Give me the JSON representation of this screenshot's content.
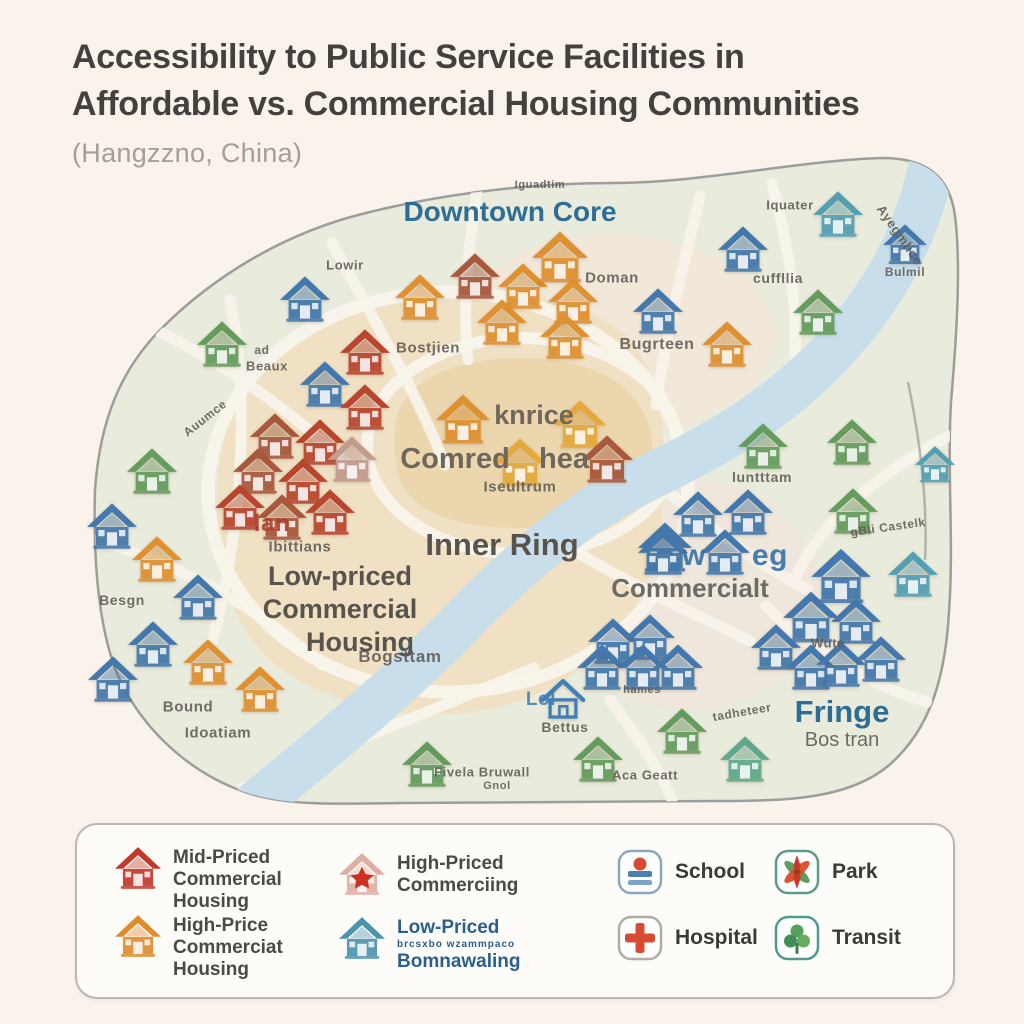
{
  "title": {
    "line1": "Accessibility to Public Service Facilities in",
    "line2": "Affordable vs. Commercial Housing Communities",
    "subtitle": "(Hangzzno, China)"
  },
  "map": {
    "region_labels": {
      "downtown_core": "Downtown Core",
      "inner_ring": "Inner Ring",
      "low_priced_1": "Low-priced",
      "low_priced_2": "Commercial",
      "low_priced_3": "Housing",
      "commercial": "Commercialt",
      "fringe": "Fringe",
      "fringe_sub": "Bos tran",
      "core_1": "knrice",
      "core_2": "Comred",
      "core_3": "hea"
    },
    "colors": {
      "red": "#b9452f",
      "brown": "#a8583c",
      "fadedred": "#c49b90",
      "orange": "#df9130",
      "yellow": "#e5a93b",
      "blue": "#4278ad",
      "teal": "#53a0b5",
      "green": "#649c5d",
      "tealgreen": "#5ea98e",
      "outline": "#3f7fb5",
      "map_sage": "#e9ebdc",
      "map_tan": "#f0e1c4",
      "map_core": "#ecd6ae",
      "river": "#c8dfeb",
      "accent_teal_text": "#2e6d94"
    },
    "houses": [
      {
        "x": 305,
        "y": 300,
        "c": "blue"
      },
      {
        "x": 222,
        "y": 345,
        "c": "green"
      },
      {
        "x": 152,
        "y": 472,
        "c": "green"
      },
      {
        "x": 112,
        "y": 527,
        "c": "blue"
      },
      {
        "x": 157,
        "y": 560,
        "c": "orange"
      },
      {
        "x": 198,
        "y": 598,
        "c": "blue"
      },
      {
        "x": 153,
        "y": 645,
        "c": "blue"
      },
      {
        "x": 113,
        "y": 680,
        "c": "blue"
      },
      {
        "x": 208,
        "y": 663,
        "c": "orange"
      },
      {
        "x": 260,
        "y": 690,
        "c": "orange"
      },
      {
        "x": 365,
        "y": 353,
        "c": "red"
      },
      {
        "x": 325,
        "y": 385,
        "c": "blue"
      },
      {
        "x": 365,
        "y": 408,
        "c": "red"
      },
      {
        "x": 275,
        "y": 437,
        "c": "brown"
      },
      {
        "x": 320,
        "y": 443,
        "c": "red"
      },
      {
        "x": 352,
        "y": 460,
        "c": "fadedred"
      },
      {
        "x": 258,
        "y": 472,
        "c": "brown"
      },
      {
        "x": 303,
        "y": 482,
        "c": "red"
      },
      {
        "x": 240,
        "y": 508,
        "c": "red"
      },
      {
        "x": 282,
        "y": 518,
        "c": "brown"
      },
      {
        "x": 330,
        "y": 513,
        "c": "red"
      },
      {
        "x": 420,
        "y": 298,
        "c": "orange"
      },
      {
        "x": 475,
        "y": 277,
        "c": "brown"
      },
      {
        "x": 523,
        "y": 287,
        "c": "orange"
      },
      {
        "x": 560,
        "y": 258,
        "c": "orange",
        "s": 56
      },
      {
        "x": 573,
        "y": 302,
        "c": "orange"
      },
      {
        "x": 502,
        "y": 323,
        "c": "orange"
      },
      {
        "x": 565,
        "y": 337,
        "c": "orange"
      },
      {
        "x": 658,
        "y": 312,
        "c": "blue"
      },
      {
        "x": 727,
        "y": 345,
        "c": "orange"
      },
      {
        "x": 463,
        "y": 420,
        "c": "orange",
        "s": 54
      },
      {
        "x": 580,
        "y": 425,
        "c": "yellow",
        "s": 52
      },
      {
        "x": 520,
        "y": 463,
        "c": "yellow",
        "s": 52
      },
      {
        "x": 607,
        "y": 460,
        "c": "brown",
        "s": 52
      },
      {
        "x": 665,
        "y": 548,
        "c": "blue",
        "s": 54
      },
      {
        "x": 743,
        "y": 250,
        "c": "blue"
      },
      {
        "x": 838,
        "y": 215,
        "c": "teal"
      },
      {
        "x": 818,
        "y": 313,
        "c": "green"
      },
      {
        "x": 905,
        "y": 245,
        "c": "blue",
        "s": 44
      },
      {
        "x": 763,
        "y": 447,
        "c": "green"
      },
      {
        "x": 852,
        "y": 443,
        "c": "green"
      },
      {
        "x": 853,
        "y": 512,
        "c": "green"
      },
      {
        "x": 935,
        "y": 465,
        "c": "teal",
        "s": 40
      },
      {
        "x": 698,
        "y": 515,
        "c": "blue"
      },
      {
        "x": 748,
        "y": 513,
        "c": "blue"
      },
      {
        "x": 663,
        "y": 553,
        "c": "blue"
      },
      {
        "x": 725,
        "y": 553,
        "c": "blue"
      },
      {
        "x": 613,
        "y": 642,
        "c": "blue"
      },
      {
        "x": 650,
        "y": 638,
        "c": "blue"
      },
      {
        "x": 602,
        "y": 668,
        "c": "blue"
      },
      {
        "x": 643,
        "y": 668,
        "c": "blue"
      },
      {
        "x": 678,
        "y": 668,
        "c": "blue"
      },
      {
        "x": 841,
        "y": 577,
        "c": "blue",
        "s": 60
      },
      {
        "x": 913,
        "y": 575,
        "c": "teal"
      },
      {
        "x": 811,
        "y": 618,
        "c": "blue",
        "s": 56
      },
      {
        "x": 856,
        "y": 622,
        "c": "blue"
      },
      {
        "x": 776,
        "y": 648,
        "c": "blue"
      },
      {
        "x": 811,
        "y": 668,
        "c": "blue"
      },
      {
        "x": 841,
        "y": 665,
        "c": "blue"
      },
      {
        "x": 881,
        "y": 660,
        "c": "blue"
      },
      {
        "x": 427,
        "y": 765,
        "c": "green"
      },
      {
        "x": 598,
        "y": 760,
        "c": "green"
      },
      {
        "x": 682,
        "y": 732,
        "c": "green"
      },
      {
        "x": 745,
        "y": 760,
        "c": "tealgreen"
      },
      {
        "x": 563,
        "y": 700,
        "c": "outline",
        "o": 1,
        "s": 46
      }
    ],
    "micro_labels": [
      {
        "t": "Iguadtim",
        "x": 540,
        "y": 185,
        "size": 11
      },
      {
        "t": "Lowir",
        "x": 345,
        "y": 265,
        "size": 13
      },
      {
        "t": "ad",
        "x": 262,
        "y": 350,
        "size": 12
      },
      {
        "t": "Beaux",
        "x": 267,
        "y": 366,
        "size": 13
      },
      {
        "t": "Auumce",
        "x": 205,
        "y": 418,
        "rot": -38,
        "size": 12
      },
      {
        "t": "Bostjien",
        "x": 428,
        "y": 348,
        "size": 15
      },
      {
        "t": "Doman",
        "x": 612,
        "y": 278,
        "size": 15
      },
      {
        "t": "Bugrteen",
        "x": 657,
        "y": 345,
        "size": 16
      },
      {
        "t": "Iquater",
        "x": 790,
        "y": 205,
        "size": 13
      },
      {
        "t": "cuffllia",
        "x": 778,
        "y": 278,
        "size": 14
      },
      {
        "t": "Ayegmlice",
        "x": 900,
        "y": 235,
        "rot": 55,
        "size": 13
      },
      {
        "t": "Bulmil",
        "x": 905,
        "y": 272,
        "size": 12
      },
      {
        "t": "luntttam",
        "x": 762,
        "y": 477,
        "size": 14
      },
      {
        "t": "gBli Castelk",
        "x": 888,
        "y": 527,
        "rot": -8,
        "size": 12
      },
      {
        "t": "lan",
        "x": 272,
        "y": 524,
        "color": "#b03b2e",
        "size": 24,
        "bold": true
      },
      {
        "t": "Ibittians",
        "x": 300,
        "y": 547,
        "size": 15
      },
      {
        "t": "Besgn",
        "x": 122,
        "y": 600,
        "size": 14
      },
      {
        "t": "Bound",
        "x": 188,
        "y": 707,
        "size": 15
      },
      {
        "t": "Idoatiam",
        "x": 218,
        "y": 733,
        "size": 15
      },
      {
        "t": "Bogsttam",
        "x": 400,
        "y": 657,
        "size": 17
      },
      {
        "t": "Iseultrum",
        "x": 520,
        "y": 487,
        "size": 15,
        "bold": true
      },
      {
        "t": "hames",
        "x": 642,
        "y": 690,
        "size": 11
      },
      {
        "t": "Lol",
        "x": 541,
        "y": 700,
        "color": "#3f7fb5",
        "size": 19,
        "bold": true
      },
      {
        "t": "Bettus",
        "x": 565,
        "y": 727,
        "size": 14
      },
      {
        "t": "Fivela Bruwall",
        "x": 482,
        "y": 772,
        "size": 13
      },
      {
        "t": "Gnol",
        "x": 497,
        "y": 786,
        "size": 11
      },
      {
        "t": "Aca Geatt",
        "x": 645,
        "y": 775,
        "size": 13
      },
      {
        "t": "tadheteer",
        "x": 742,
        "y": 712,
        "rot": -10,
        "size": 12
      },
      {
        "t": "Wute",
        "x": 828,
        "y": 643,
        "size": 13,
        "bold": true
      },
      {
        "t": "w",
        "x": 694,
        "y": 556,
        "color": "#2f6ea8",
        "size": 30,
        "bold": true
      },
      {
        "t": "eg",
        "x": 770,
        "y": 556,
        "color": "#2f6ea8",
        "size": 30,
        "bold": true
      }
    ]
  },
  "legend": {
    "housing": [
      {
        "lines": [
          "Mid-Priced",
          "Commercial",
          "Housing"
        ]
      },
      {
        "lines": [
          "High-Priced",
          "Commerciing"
        ]
      },
      {
        "lines": [
          "High-Price",
          "Commerciat",
          "Housing"
        ]
      },
      {
        "lines": [
          "Low-Priced",
          "brcsxbo wzammpaco",
          "Bomnawaling"
        ]
      }
    ],
    "facilities": [
      {
        "label": "School"
      },
      {
        "label": "Park"
      },
      {
        "label": "Hospital"
      },
      {
        "label": "Transit"
      }
    ]
  }
}
